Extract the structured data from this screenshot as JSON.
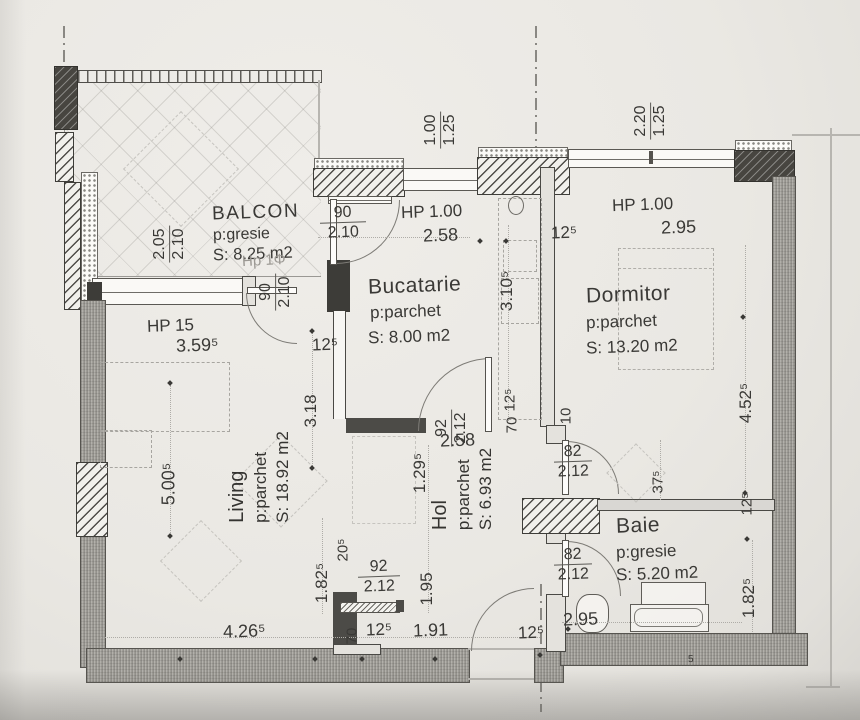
{
  "rooms": {
    "balcon": {
      "name": "BALCON",
      "floor": "p:gresie",
      "area": "S: 8.25 m2",
      "note": "Hp 1Φ"
    },
    "bucatarie": {
      "name": "Bucatarie",
      "floor": "p:parchet",
      "area": "S: 8.00 m2"
    },
    "dormitor": {
      "name": "Dormitor",
      "floor": "p:parchet",
      "area": "S: 13.20 m2"
    },
    "living": {
      "name": "Living",
      "floor": "p:parchet",
      "area": "S: 18.92 m2"
    },
    "hol": {
      "name": "Hol",
      "floor": "p:parchet",
      "area": "S: 6.93 m2"
    },
    "baie": {
      "name": "Baie",
      "floor": "p:gresie",
      "area": "S: 5.20 m2"
    }
  },
  "windows": {
    "kitchen": {
      "label": "HP 1.00",
      "width": "2.58"
    },
    "bedroom": {
      "label": "HP 1.00",
      "width": "2.95"
    },
    "living": {
      "label": "HP 15",
      "width": "3.59⁵"
    }
  },
  "doors": {
    "balcony_kitchen": {
      "w": "90",
      "h": "2.10"
    },
    "balcony_living": {
      "w": "90",
      "h": "2.10"
    },
    "kitchen": {
      "w": "92",
      "h": "2.12"
    },
    "bedroom": {
      "w": "82",
      "h": "2.12"
    },
    "bathroom": {
      "w": "82",
      "h": "2.12"
    },
    "entrance": {
      "w": "92",
      "h": "2.12"
    }
  },
  "dims": {
    "v100": "1.00",
    "v125": "1.25",
    "v220": "2.20",
    "v205": "2.05",
    "v210": "2.10",
    "w125": "12⁵",
    "w70": "70",
    "w10": "10",
    "w375": "37⁵",
    "w205": "20⁵",
    "living_width": "5.00⁵",
    "living_bottom": "4.26⁵",
    "living_lower": "1.82⁵",
    "living_upper": "3.18",
    "kitchen_depth": "3.10⁵",
    "hol_width": "2.58",
    "hol_upper": "1.29⁵",
    "hol_lower": "1.95",
    "hol_bottom": "1.91",
    "bath_width": "2.95",
    "bath_height": "1.82⁵",
    "bedroom_depth": "4.52⁵",
    "tub": "5"
  },
  "colors": {
    "paper": "#eae8e3",
    "ink": "#3a3936",
    "wall": "#a9a7a1"
  }
}
